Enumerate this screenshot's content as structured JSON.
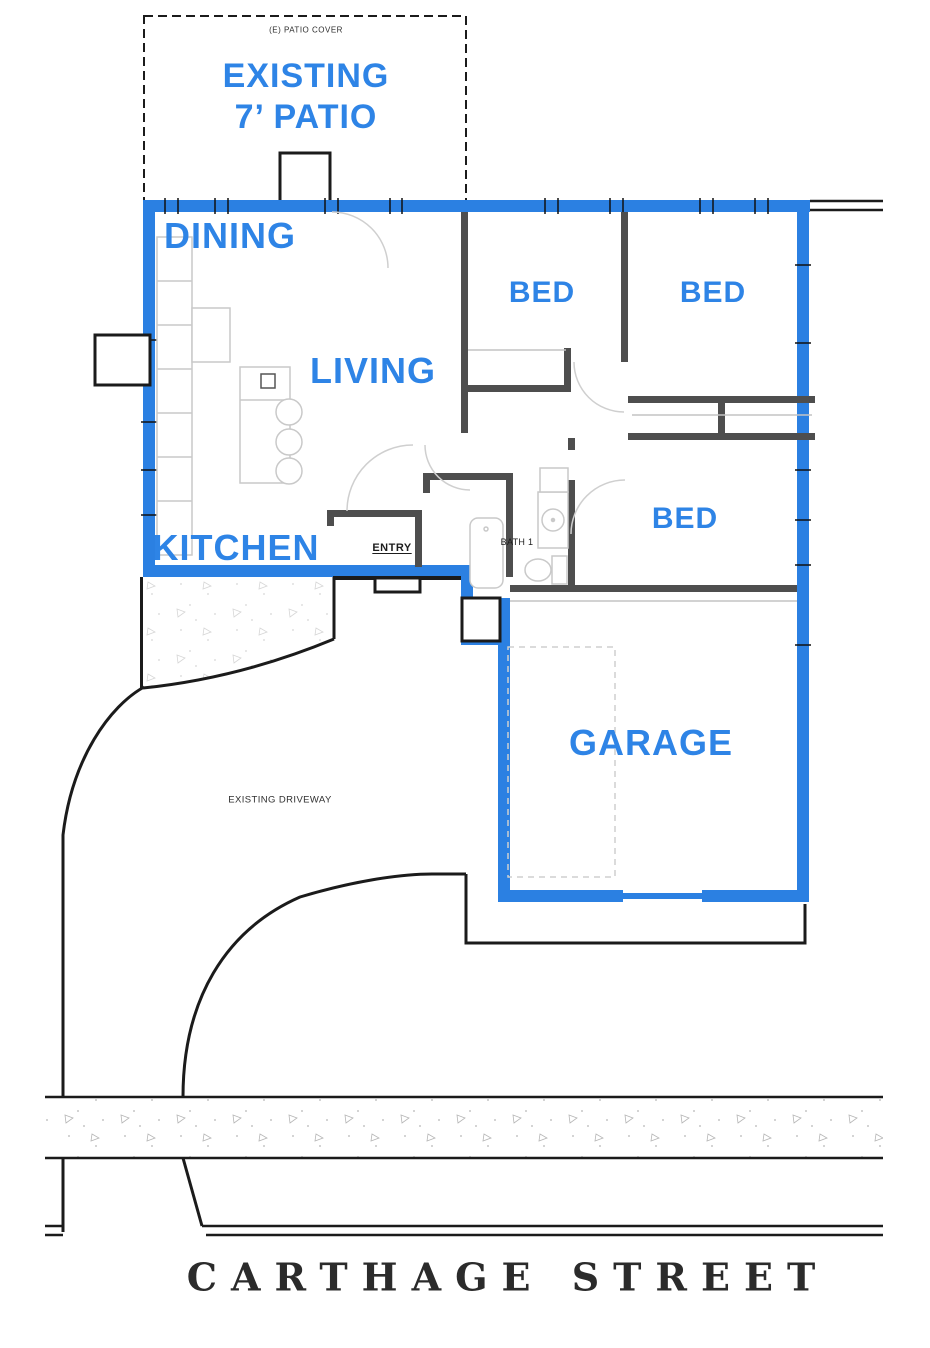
{
  "plan": {
    "labels": {
      "patio_cover": "(E) PATIO COVER",
      "patio_line1": "EXISTING",
      "patio_line2": "7’ PATIO",
      "dining": "DINING",
      "living": "LIVING",
      "kitchen": "KITCHEN",
      "bed1": "BED",
      "bed2": "BED",
      "bed3": "BED",
      "garage": "GARAGE",
      "entry": "ENTRY",
      "bath": "BATH 1",
      "driveway": "EXISTING DRIVEWAY",
      "street": "CARTHAGE STREET"
    },
    "colors": {
      "accent_blue": "#2b80e2",
      "label_blue": "#2e84e6",
      "line_black": "#1b1b1b",
      "interior_wall_gray": "#4e4e4e",
      "fixture_gray": "#c9c9c9",
      "street_text": "#2b2b2b"
    }
  }
}
